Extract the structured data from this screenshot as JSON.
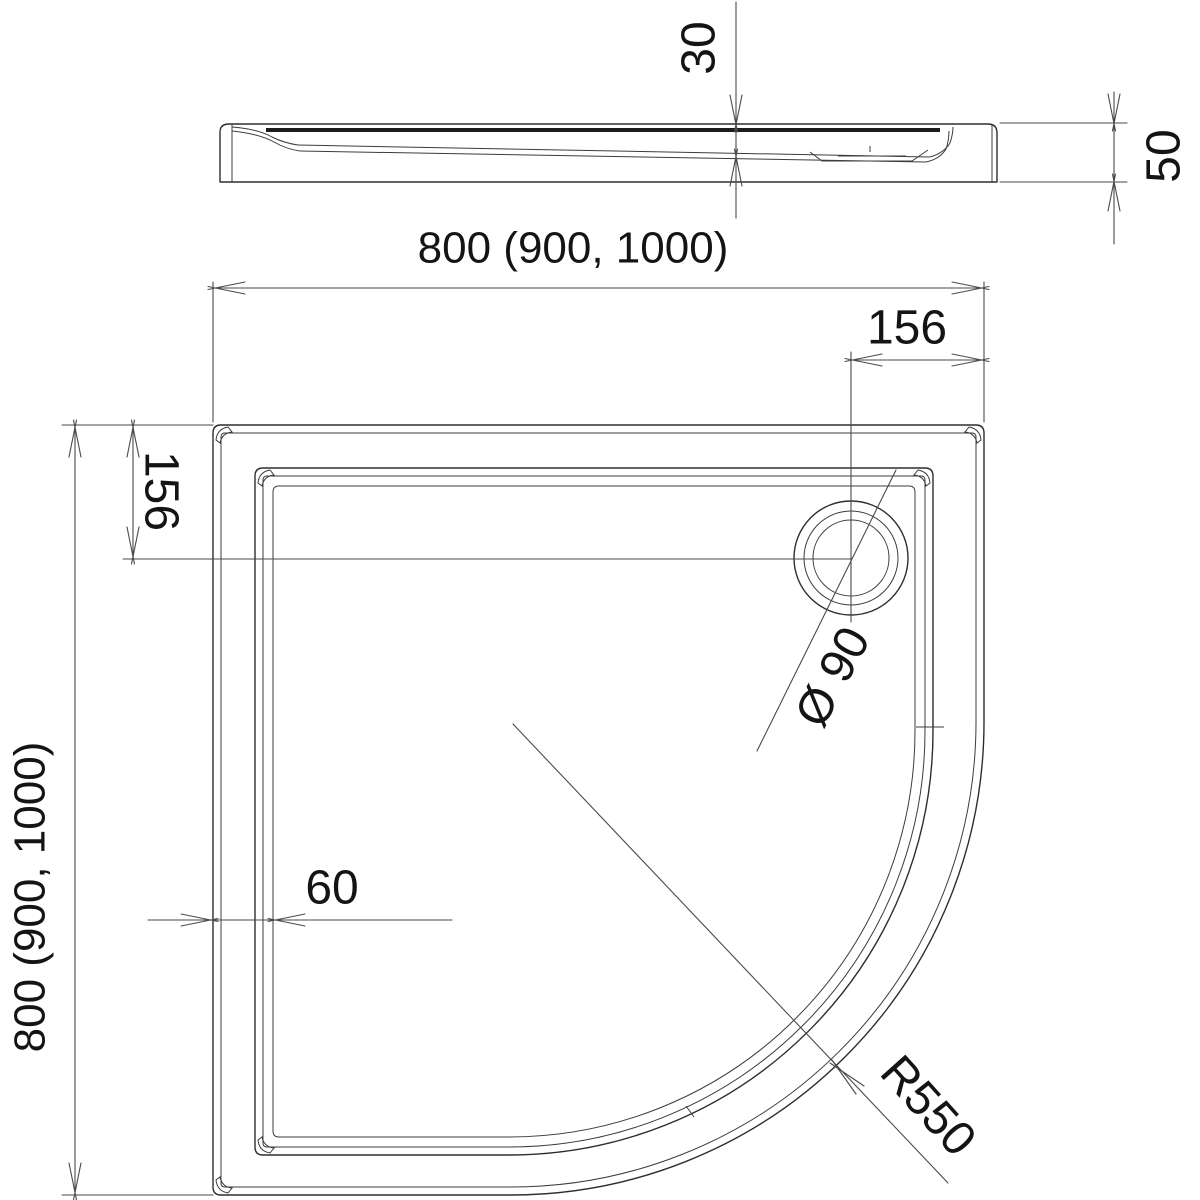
{
  "drawing": {
    "type": "technical-dimension-drawing",
    "subject": "quadrant-shower-tray",
    "background_color": "#ffffff",
    "line_color": "#2e2e2e",
    "dimension_line_color": "#4a4a4a",
    "text_color": "#141414",
    "labels": {
      "width_top": "800 (900, 1000)",
      "depth_left": "800 (900, 1000)",
      "rim_depth": "30",
      "tray_height": "50",
      "drain_offset_top": "156",
      "drain_offset_left": "156",
      "wall_thickness": "60",
      "drain_diameter": "Ø 90",
      "corner_radius": "R550"
    }
  }
}
